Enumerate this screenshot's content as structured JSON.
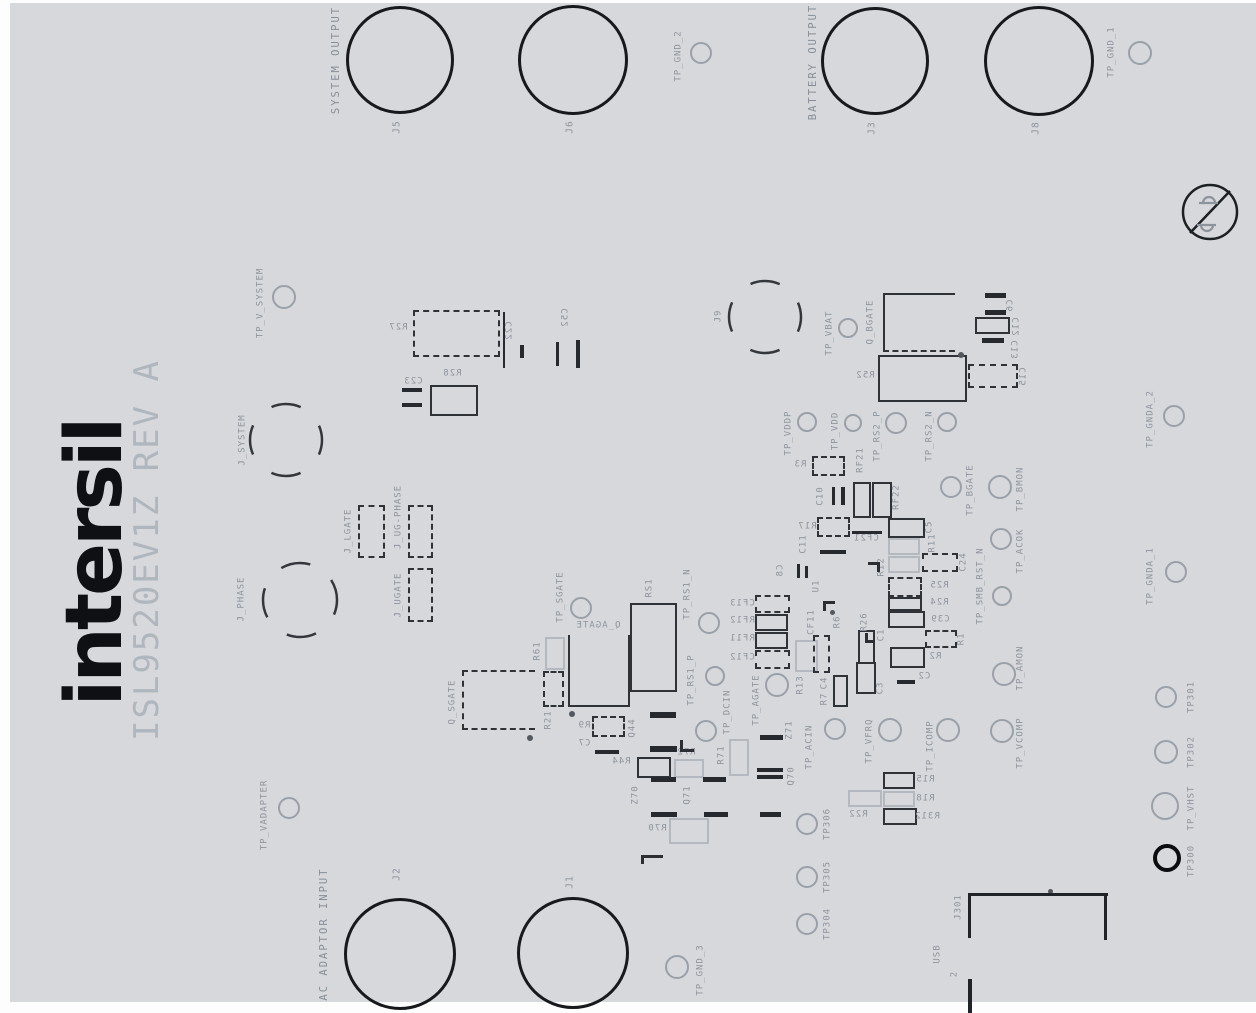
{
  "logo": {
    "brand": "intersil",
    "title": "ISL9520EV1Z REV A"
  },
  "group_labels": [
    {
      "text": "SYSTEM OUTPUT",
      "x": 336,
      "y": 60
    },
    {
      "text": "BATTERY OUTPUT",
      "x": 813,
      "y": 62
    },
    {
      "text": "AC ADAPTOR INPUT",
      "x": 324,
      "y": 934
    }
  ],
  "banana_jacks": [
    {
      "id": "J5",
      "label": "J5",
      "cx": 397,
      "cy": 57,
      "r": 51,
      "lx": 397,
      "ly": 127
    },
    {
      "id": "J6",
      "label": "J6",
      "cx": 570,
      "cy": 57,
      "r": 52,
      "lx": 570,
      "ly": 127
    },
    {
      "id": "J3",
      "label": "J3",
      "cx": 872,
      "cy": 58,
      "r": 51,
      "lx": 872,
      "ly": 128
    },
    {
      "id": "J8",
      "label": "J8",
      "cx": 1036,
      "cy": 58,
      "r": 52,
      "lx": 1036,
      "ly": 128
    },
    {
      "id": "J2",
      "label": "J2",
      "cx": 397,
      "cy": 951,
      "r": 53,
      "lx": 397,
      "ly": 874
    },
    {
      "id": "J1",
      "label": "J1",
      "cx": 570,
      "cy": 950,
      "r": 53,
      "lx": 570,
      "ly": 882
    }
  ],
  "jumper_circles": [
    {
      "id": "J_SYSTEM",
      "label": "J_SYSTEM",
      "cx": 286,
      "cy": 440,
      "r": 36,
      "lx": 243,
      "ly": 440
    },
    {
      "id": "J_PHASE",
      "label": "J_PHASE",
      "cx": 300,
      "cy": 600,
      "r": 37,
      "lx": 242,
      "ly": 599
    },
    {
      "id": "J9",
      "label": "J9",
      "cx": 765,
      "cy": 317,
      "r": 36,
      "lx": 719,
      "ly": 316
    }
  ],
  "test_points": [
    {
      "id": "TP_GND_2",
      "label": "TP_GND_2",
      "cx": 701,
      "cy": 53,
      "r": 11,
      "lx": 679,
      "ly": 56
    },
    {
      "id": "TP_GND_1",
      "label": "TP_GND_1",
      "cx": 1140,
      "cy": 53,
      "r": 12,
      "lx": 1112,
      "ly": 52
    },
    {
      "id": "TP_V_SYSTEM",
      "label": "TP_V_SYSTEM",
      "cx": 284,
      "cy": 297,
      "r": 12,
      "lx": 261,
      "ly": 303
    },
    {
      "id": "TP_VBAT",
      "label": "TP_VBAT",
      "cx": 848,
      "cy": 328,
      "r": 10,
      "lx": 830,
      "ly": 333
    },
    {
      "id": "TP_VDDP",
      "label": "TP_VDDP",
      "cx": 807,
      "cy": 422,
      "r": 10,
      "lx": 789,
      "ly": 433
    },
    {
      "id": "TP_VDD",
      "label": "TP_VDD",
      "cx": 853,
      "cy": 423,
      "r": 9,
      "lx": 836,
      "ly": 431
    },
    {
      "id": "TP_RS2_P",
      "label": "TP_RS2_P",
      "cx": 896,
      "cy": 423,
      "r": 11,
      "lx": 878,
      "ly": 436
    },
    {
      "id": "TP_RS2_N",
      "label": "TP_RS2_N",
      "cx": 947,
      "cy": 422,
      "r": 10,
      "lx": 930,
      "ly": 436
    },
    {
      "id": "TP_GNDA_2",
      "label": "TP_GNDA_2",
      "cx": 1174,
      "cy": 416,
      "r": 11,
      "lx": 1151,
      "ly": 419
    },
    {
      "id": "TP_BGATE",
      "label": "TP_BGATE",
      "cx": 951,
      "cy": 487,
      "r": 11,
      "lx": 971,
      "ly": 490
    },
    {
      "id": "TP_BMON",
      "label": "TP_BMON",
      "cx": 1000,
      "cy": 487,
      "r": 12,
      "lx": 1021,
      "ly": 489
    },
    {
      "id": "TP_ACOK",
      "label": "TP_ACOK",
      "cx": 1001,
      "cy": 539,
      "r": 11,
      "lx": 1021,
      "ly": 551
    },
    {
      "id": "TP_SMB_RST_N",
      "label": "TP_SMB_RST_N",
      "cx": 1002,
      "cy": 596,
      "r": 10,
      "lx": 981,
      "ly": 586
    },
    {
      "id": "TP_GNDA_1",
      "label": "TP_GNDA_1",
      "cx": 1176,
      "cy": 572,
      "r": 11,
      "lx": 1151,
      "ly": 576
    },
    {
      "id": "TP_RS1_N",
      "label": "TP_RS1_N",
      "cx": 709,
      "cy": 623,
      "r": 11,
      "lx": 688,
      "ly": 594
    },
    {
      "id": "TP_RS1_P",
      "label": "TP_RS1_P",
      "cx": 715,
      "cy": 676,
      "r": 10,
      "lx": 692,
      "ly": 680
    },
    {
      "id": "TP_SGATE",
      "label": "TP_SGATE",
      "cx": 581,
      "cy": 608,
      "r": 11,
      "lx": 561,
      "ly": 597
    },
    {
      "id": "TP_AGATE",
      "label": "TP_AGATE",
      "cx": 777,
      "cy": 685,
      "r": 12,
      "lx": 757,
      "ly": 700
    },
    {
      "id": "TP_DCIN",
      "label": "TP_DCIN",
      "cx": 706,
      "cy": 731,
      "r": 11,
      "lx": 728,
      "ly": 712
    },
    {
      "id": "TP_ACIN",
      "label": "TP_ACIN",
      "cx": 835,
      "cy": 729,
      "r": 11,
      "lx": 810,
      "ly": 747
    },
    {
      "id": "TP_VFRQ",
      "label": "TP_VFRQ",
      "cx": 890,
      "cy": 730,
      "r": 12,
      "lx": 870,
      "ly": 741
    },
    {
      "id": "TP_ICOMP",
      "label": "TP_ICOMP",
      "cx": 948,
      "cy": 730,
      "r": 12,
      "lx": 931,
      "ly": 746
    },
    {
      "id": "TP_VCOMP",
      "label": "TP_VCOMP",
      "cx": 1002,
      "cy": 731,
      "r": 12,
      "lx": 1021,
      "ly": 743
    },
    {
      "id": "TP_AMON",
      "label": "TP_AMON",
      "cx": 1004,
      "cy": 674,
      "r": 12,
      "lx": 1021,
      "ly": 668
    },
    {
      "id": "TP306",
      "label": "TP306",
      "cx": 807,
      "cy": 824,
      "r": 11,
      "lx": 828,
      "ly": 824
    },
    {
      "id": "TP305",
      "label": "TP305",
      "cx": 807,
      "cy": 877,
      "r": 11,
      "lx": 828,
      "ly": 877
    },
    {
      "id": "TP304",
      "label": "TP304",
      "cx": 807,
      "cy": 924,
      "r": 11,
      "lx": 828,
      "ly": 924
    },
    {
      "id": "TP_GND_3",
      "label": "TP_GND_3",
      "cx": 677,
      "cy": 967,
      "r": 12,
      "lx": 701,
      "ly": 970
    },
    {
      "id": "TP_VADAPTER",
      "label": "TP_VADAPTER",
      "cx": 289,
      "cy": 808,
      "r": 11,
      "lx": 265,
      "ly": 815
    },
    {
      "id": "TP301",
      "label": "TP301",
      "cx": 1166,
      "cy": 697,
      "r": 11,
      "lx": 1192,
      "ly": 697
    },
    {
      "id": "TP302",
      "label": "TP302",
      "cx": 1166,
      "cy": 752,
      "r": 12,
      "lx": 1192,
      "ly": 752
    },
    {
      "id": "TP_VHST",
      "label": "TP_VHST",
      "cx": 1165,
      "cy": 806,
      "r": 14,
      "lx": 1192,
      "ly": 808
    },
    {
      "id": "TP300",
      "label": "TP300",
      "cx": 1167,
      "cy": 858,
      "r": 14,
      "lx": 1192,
      "ly": 861,
      "bold": true
    }
  ],
  "components": [
    {
      "id": "R27",
      "x": 413,
      "y": 310,
      "w": 87,
      "h": 47,
      "cls": "dkd",
      "label": "R27",
      "lx": 398,
      "ly": 328,
      "rot": "rhm"
    },
    {
      "id": "R28",
      "x": 430,
      "y": 385,
      "w": 48,
      "h": 31,
      "cls": "dk",
      "label": "R28",
      "lx": 452,
      "ly": 374,
      "rot": "rhm"
    },
    {
      "id": "J_LGATE",
      "x": 358,
      "y": 505,
      "w": 27,
      "h": 53,
      "cls": "dkd",
      "label": "J_LGATE",
      "lx": 349,
      "ly": 531,
      "rot": "rv"
    },
    {
      "id": "J_UG-PHASE",
      "x": 408,
      "y": 505,
      "w": 25,
      "h": 53,
      "cls": "dkd",
      "label": "J_UG-PHASE",
      "lx": 399,
      "ly": 517,
      "rot": "rv"
    },
    {
      "id": "J_UGATE",
      "x": 408,
      "y": 568,
      "w": 25,
      "h": 54,
      "cls": "dkd",
      "label": "J_UGATE",
      "lx": 399,
      "ly": 595,
      "rot": "rv"
    },
    {
      "id": "Q_SGATE",
      "x": 462,
      "y": 670,
      "w": 73,
      "h": 60,
      "cls": "dkd open-r",
      "label": "Q_SGATE",
      "lx": 453,
      "ly": 702,
      "rot": "rv"
    },
    {
      "id": "R61",
      "x": 545,
      "y": 637,
      "w": 20,
      "h": 33,
      "cls": "lt",
      "label": "R61",
      "lx": 538,
      "ly": 651,
      "rot": "rv"
    },
    {
      "id": "R21",
      "x": 543,
      "y": 671,
      "w": 21,
      "h": 36,
      "cls": "dkd",
      "label": "R21",
      "lx": 549,
      "ly": 720,
      "rot": "rv"
    },
    {
      "id": "Q_AGATE",
      "x": 568,
      "y": 635,
      "w": 62,
      "h": 72,
      "cls": "dk open-t",
      "label": "Q_AGATE",
      "lx": 598,
      "ly": 626,
      "rot": "rhm"
    },
    {
      "id": "RS1",
      "x": 630,
      "y": 603,
      "w": 47,
      "h": 89,
      "cls": "dk",
      "label": "RS1",
      "lx": 650,
      "ly": 588,
      "rot": "rv"
    },
    {
      "id": "R9",
      "x": 592,
      "y": 716,
      "w": 33,
      "h": 21,
      "cls": "dkd",
      "label": "R9",
      "lx": 584,
      "ly": 726,
      "rot": "rhm"
    },
    {
      "id": "R44",
      "x": 637,
      "y": 757,
      "w": 34,
      "h": 21,
      "cls": "dk",
      "label": "R44",
      "lx": 621,
      "ly": 762,
      "rot": "rhm"
    },
    {
      "id": "R72",
      "x": 674,
      "y": 759,
      "w": 30,
      "h": 19,
      "cls": "lt",
      "label": "R72",
      "lx": 686,
      "ly": 753,
      "rot": "rhm"
    },
    {
      "id": "R70",
      "x": 669,
      "y": 818,
      "w": 40,
      "h": 26,
      "cls": "lt",
      "label": "R70",
      "lx": 657,
      "ly": 829,
      "rot": "rhm"
    },
    {
      "id": "R71",
      "x": 729,
      "y": 739,
      "w": 20,
      "h": 37,
      "cls": "lt",
      "label": "R71",
      "lx": 722,
      "ly": 755,
      "rot": "rv"
    },
    {
      "id": "CF13",
      "x": 755,
      "y": 595,
      "w": 35,
      "h": 18,
      "cls": "dkd",
      "label": "CF13",
      "lx": 742,
      "ly": 604,
      "rot": "rhm"
    },
    {
      "id": "RF12",
      "x": 755,
      "y": 614,
      "w": 33,
      "h": 17,
      "cls": "dk",
      "label": "RF12",
      "lx": 742,
      "ly": 621,
      "rot": "rhm"
    },
    {
      "id": "RF11",
      "x": 755,
      "y": 632,
      "w": 33,
      "h": 17,
      "cls": "dk",
      "label": "RF11",
      "lx": 742,
      "ly": 639,
      "rot": "rhm"
    },
    {
      "id": "CF12",
      "x": 755,
      "y": 650,
      "w": 35,
      "h": 19,
      "cls": "dkd",
      "label": "CF12",
      "lx": 742,
      "ly": 658,
      "rot": "rhm"
    },
    {
      "id": "R13",
      "x": 795,
      "y": 640,
      "w": 23,
      "h": 32,
      "cls": "lt",
      "label": "R13",
      "lx": 801,
      "ly": 685,
      "rot": "rv"
    },
    {
      "id": "C4-body",
      "x": 813,
      "y": 635,
      "w": 17,
      "h": 38,
      "cls": "dkd"
    },
    {
      "id": "R7-body",
      "x": 833,
      "y": 675,
      "w": 15,
      "h": 32,
      "cls": "dk"
    },
    {
      "id": "R26-body",
      "x": 858,
      "y": 630,
      "w": 17,
      "h": 34,
      "cls": "dk"
    },
    {
      "id": "C3",
      "x": 856,
      "y": 662,
      "w": 20,
      "h": 32,
      "cls": "dk",
      "label": "C3",
      "lx": 881,
      "ly": 688,
      "rot": "rv"
    },
    {
      "id": "R3",
      "x": 812,
      "y": 456,
      "w": 33,
      "h": 20,
      "cls": "dkd",
      "label": "R3",
      "lx": 800,
      "ly": 465,
      "rot": "rhm"
    },
    {
      "id": "RF21-body",
      "x": 853,
      "y": 482,
      "w": 18,
      "h": 36,
      "cls": "dk"
    },
    {
      "id": "RF22-body",
      "x": 872,
      "y": 482,
      "w": 20,
      "h": 36,
      "cls": "dk"
    },
    {
      "id": "R17",
      "x": 817,
      "y": 517,
      "w": 33,
      "h": 20,
      "cls": "dkd",
      "label": "R17",
      "lx": 807,
      "ly": 527,
      "rot": "rhm"
    },
    {
      "id": "C5",
      "x": 888,
      "y": 518,
      "w": 37,
      "h": 20,
      "cls": "dk",
      "label": "C5",
      "lx": 930,
      "ly": 527,
      "rot": "rv"
    },
    {
      "id": "R11",
      "x": 888,
      "y": 538,
      "w": 32,
      "h": 17,
      "cls": "lt",
      "label": "R11",
      "lx": 933,
      "ly": 543,
      "rot": "rv"
    },
    {
      "id": "R12",
      "x": 888,
      "y": 556,
      "w": 32,
      "h": 17,
      "cls": "lt",
      "label": "R12",
      "lx": 882,
      "ly": 567,
      "rot": "rv"
    },
    {
      "id": "C24",
      "x": 922,
      "y": 553,
      "w": 36,
      "h": 19,
      "cls": "dkd",
      "label": "C24",
      "lx": 964,
      "ly": 562,
      "rot": "rv"
    },
    {
      "id": "R25",
      "x": 888,
      "y": 577,
      "w": 34,
      "h": 20,
      "cls": "dkd",
      "label": "R25",
      "lx": 939,
      "ly": 586,
      "rot": "rhm"
    },
    {
      "id": "R24",
      "x": 888,
      "y": 597,
      "w": 34,
      "h": 14,
      "cls": "dk",
      "label": "R24",
      "lx": 939,
      "ly": 603,
      "rot": "rhm"
    },
    {
      "id": "C39",
      "x": 888,
      "y": 611,
      "w": 37,
      "h": 17,
      "cls": "dk",
      "label": "C39",
      "lx": 940,
      "ly": 620,
      "rot": "rhm"
    },
    {
      "id": "R1",
      "x": 925,
      "y": 630,
      "w": 32,
      "h": 18,
      "cls": "dkd",
      "label": "R1",
      "lx": 962,
      "ly": 639,
      "rot": "rv"
    },
    {
      "id": "R2",
      "x": 890,
      "y": 647,
      "w": 35,
      "h": 21,
      "cls": "dk",
      "label": "R2",
      "lx": 935,
      "ly": 657,
      "rot": "rhm"
    },
    {
      "id": "Q_BGATE",
      "x": 883,
      "y": 293,
      "w": 72,
      "h": 59,
      "cls": "dk qb",
      "label": "Q_BGATE",
      "lx": 871,
      "ly": 322,
      "rot": "rv"
    },
    {
      "id": "R52",
      "x": 878,
      "y": 355,
      "w": 89,
      "h": 47,
      "cls": "dk",
      "label": "R52",
      "lx": 865,
      "ly": 376,
      "rot": "rhm"
    },
    {
      "id": "C12",
      "x": 975,
      "y": 317,
      "w": 35,
      "h": 17,
      "cls": "dk",
      "label": "C12",
      "lx": 1017,
      "ly": 327,
      "rot": "rvm"
    },
    {
      "id": "C15",
      "x": 968,
      "y": 364,
      "w": 50,
      "h": 24,
      "cls": "dkd",
      "label": "C15",
      "lx": 1024,
      "ly": 377,
      "rot": "rvm"
    },
    {
      "id": "R15",
      "x": 883,
      "y": 772,
      "w": 32,
      "h": 17,
      "cls": "dk",
      "label": "R15",
      "lx": 925,
      "ly": 780,
      "rot": "rhm"
    },
    {
      "id": "R18",
      "x": 883,
      "y": 791,
      "w": 32,
      "h": 16,
      "cls": "lt",
      "label": "R18",
      "lx": 925,
      "ly": 799,
      "rot": "rhm"
    },
    {
      "id": "R312",
      "x": 883,
      "y": 808,
      "w": 34,
      "h": 17,
      "cls": "dk",
      "label": "R312",
      "lx": 927,
      "ly": 817,
      "rot": "rhm"
    },
    {
      "id": "R22",
      "x": 848,
      "y": 790,
      "w": 34,
      "h": 17,
      "cls": "lt",
      "label": "R22",
      "lx": 858,
      "ly": 815,
      "rot": "rhm"
    }
  ],
  "labels": [
    {
      "t": "C22",
      "x": 510,
      "y": 331,
      "r": "rvm"
    },
    {
      "t": "C52",
      "x": 566,
      "y": 318,
      "r": "rvm"
    },
    {
      "t": "C23",
      "x": 413,
      "y": 382,
      "r": "rhm"
    },
    {
      "t": "C7",
      "x": 584,
      "y": 744,
      "r": "rhm"
    },
    {
      "t": "Q44",
      "x": 633,
      "y": 728,
      "r": "rv"
    },
    {
      "t": "Z70",
      "x": 636,
      "y": 795,
      "r": "rv"
    },
    {
      "t": "Q71",
      "x": 688,
      "y": 795,
      "r": "rv"
    },
    {
      "t": "Z71",
      "x": 790,
      "y": 730,
      "r": "rv"
    },
    {
      "t": "Q70",
      "x": 792,
      "y": 776,
      "r": "rv"
    },
    {
      "t": "C8",
      "x": 781,
      "y": 571,
      "r": "rvm"
    },
    {
      "t": "U1",
      "x": 817,
      "y": 586,
      "r": "rv"
    },
    {
      "t": "CF11",
      "x": 812,
      "y": 622,
      "r": "rv"
    },
    {
      "t": "R6",
      "x": 838,
      "y": 622,
      "r": "rv"
    },
    {
      "t": "R26",
      "x": 865,
      "y": 622,
      "r": "rv"
    },
    {
      "t": "C1",
      "x": 882,
      "y": 635,
      "r": "rv"
    },
    {
      "t": "C4",
      "x": 825,
      "y": 683,
      "r": "rv"
    },
    {
      "t": "R7",
      "x": 825,
      "y": 699,
      "r": "rv"
    },
    {
      "t": "C10",
      "x": 821,
      "y": 496,
      "r": "rv"
    },
    {
      "t": "RF21",
      "x": 861,
      "y": 460,
      "r": "rv"
    },
    {
      "t": "RF22",
      "x": 897,
      "y": 497,
      "r": "rv"
    },
    {
      "t": "C11",
      "x": 804,
      "y": 544,
      "r": "rv"
    },
    {
      "t": "CF21",
      "x": 866,
      "y": 539,
      "r": "rhm"
    },
    {
      "t": "C2",
      "x": 924,
      "y": 677,
      "r": "rhm"
    },
    {
      "t": "C6",
      "x": 1011,
      "y": 306,
      "r": "rvm"
    },
    {
      "t": "C13",
      "x": 1016,
      "y": 350,
      "r": "rvm"
    },
    {
      "t": "J301",
      "x": 959,
      "y": 907,
      "r": "rv"
    },
    {
      "t": "USB",
      "x": 938,
      "y": 954,
      "r": "rv"
    },
    {
      "t": "2",
      "x": 955,
      "y": 974,
      "r": "rv"
    }
  ],
  "pads": [
    {
      "x": 650,
      "y": 712,
      "w": 26,
      "h": 6
    },
    {
      "x": 650,
      "y": 746,
      "w": 27,
      "h": 6
    },
    {
      "x": 651,
      "y": 777,
      "w": 25,
      "h": 5
    },
    {
      "x": 651,
      "y": 812,
      "w": 26,
      "h": 5
    },
    {
      "x": 703,
      "y": 777,
      "w": 23,
      "h": 5
    },
    {
      "x": 704,
      "y": 812,
      "w": 24,
      "h": 5
    },
    {
      "x": 760,
      "y": 735,
      "w": 23,
      "h": 5
    },
    {
      "x": 757,
      "y": 768,
      "w": 26,
      "h": 4
    },
    {
      "x": 757,
      "y": 775,
      "w": 26,
      "h": 4
    },
    {
      "x": 760,
      "y": 812,
      "w": 21,
      "h": 5
    },
    {
      "x": 595,
      "y": 750,
      "w": 24,
      "h": 4
    },
    {
      "x": 402,
      "y": 388,
      "w": 20,
      "h": 4
    },
    {
      "x": 402,
      "y": 403,
      "w": 20,
      "h": 4
    },
    {
      "x": 520,
      "y": 345,
      "w": 4,
      "h": 13
    },
    {
      "x": 556,
      "y": 342,
      "w": 3,
      "h": 24
    },
    {
      "x": 576,
      "y": 340,
      "w": 4,
      "h": 28
    },
    {
      "x": 797,
      "y": 564,
      "w": 3,
      "h": 14
    },
    {
      "x": 805,
      "y": 566,
      "w": 3,
      "h": 12
    },
    {
      "x": 985,
      "y": 293,
      "w": 21,
      "h": 5
    },
    {
      "x": 985,
      "y": 310,
      "w": 21,
      "h": 5
    },
    {
      "x": 982,
      "y": 338,
      "w": 22,
      "h": 5
    },
    {
      "x": 820,
      "y": 550,
      "w": 26,
      "h": 4
    },
    {
      "x": 852,
      "y": 531,
      "w": 30,
      "h": 3
    },
    {
      "x": 897,
      "y": 680,
      "w": 18,
      "h": 4
    },
    {
      "x": 832,
      "y": 487,
      "w": 3,
      "h": 18
    },
    {
      "x": 841,
      "y": 487,
      "w": 4,
      "h": 18
    },
    {
      "x": 503,
      "y": 312,
      "w": 2,
      "h": 56
    }
  ],
  "dots": [
    {
      "x": 527,
      "y": 735,
      "s": 6
    },
    {
      "x": 569,
      "y": 711,
      "s": 6
    },
    {
      "x": 958,
      "y": 352,
      "s": 6
    },
    {
      "x": 1048,
      "y": 889,
      "s": 5
    },
    {
      "x": 830,
      "y": 610,
      "s": 5
    }
  ],
  "corners": [
    {
      "x": 868,
      "y": 562,
      "w": 12,
      "h": 10,
      "t": "c-tr"
    },
    {
      "x": 823,
      "y": 601,
      "w": 12,
      "h": 10,
      "t": "c-tl"
    },
    {
      "x": 865,
      "y": 633,
      "w": 10,
      "h": 10,
      "t": "c-bl"
    },
    {
      "x": 641,
      "y": 855,
      "w": 22,
      "h": 9,
      "t": "c-tl"
    },
    {
      "x": 680,
      "y": 740,
      "w": 14,
      "h": 12,
      "t": "c-bl"
    }
  ],
  "lines": [
    {
      "x": 968,
      "y": 893,
      "w": 140,
      "h": 3
    },
    {
      "x": 1104,
      "y": 896,
      "w": 3,
      "h": 44
    },
    {
      "x": 968,
      "y": 896,
      "w": 3,
      "h": 42
    },
    {
      "x": 968,
      "y": 979,
      "w": 4,
      "h": 34
    }
  ]
}
